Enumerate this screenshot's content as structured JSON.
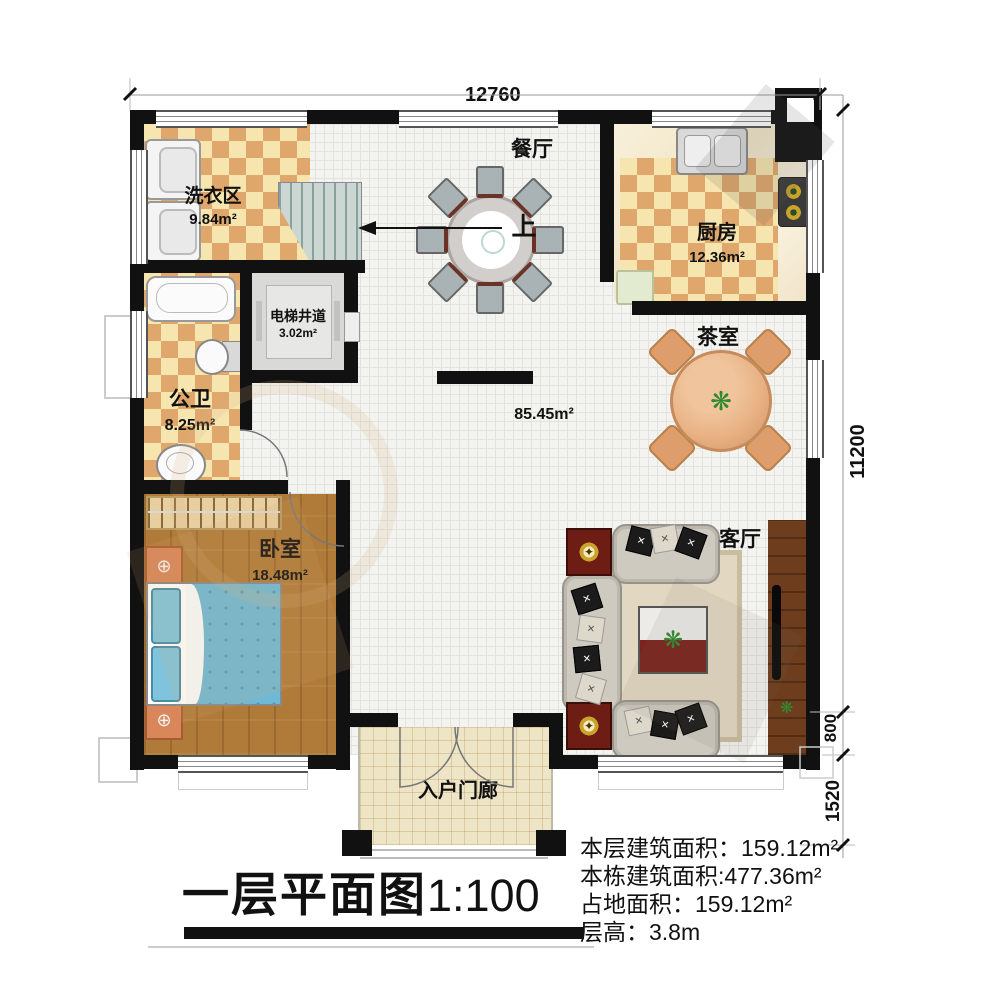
{
  "title": {
    "main": "一层平面图",
    "scale": "1:100"
  },
  "dimensions": {
    "top_width": "12760",
    "right_height": "11200",
    "right_lower": "800",
    "right_bottom": "1520"
  },
  "rooms": {
    "laundry": {
      "name": "洗衣区",
      "area": "9.84m²"
    },
    "dining": {
      "name": "餐厅"
    },
    "kitchen": {
      "name": "厨房",
      "area": "12.36m²"
    },
    "elevator": {
      "name": "电梯井道",
      "area": "3.02m²"
    },
    "bathroom": {
      "name": "公卫",
      "area": "8.25m²"
    },
    "hall": {
      "area": "85.45m²"
    },
    "tea": {
      "name": "茶室"
    },
    "bedroom": {
      "name": "卧室",
      "area": "18.48m²"
    },
    "living": {
      "name": "客厅"
    },
    "porch": {
      "name": "入户门廊"
    }
  },
  "stairs": {
    "up_label": "上"
  },
  "info": {
    "lines": [
      {
        "label": "本层建筑面积：",
        "value": "159.12m²"
      },
      {
        "label": "本栋建筑面积:",
        "value": "477.36m²"
      },
      {
        "label": "占地面积：",
        "value": "159.12m²"
      },
      {
        "label": "层高：",
        "value": "3.8m"
      }
    ]
  },
  "colors": {
    "wall": "#111111",
    "checker_dark": "#e0a76c",
    "checker_light": "#f7e5b0",
    "bedroom_wood": "#b07b39",
    "bed_blue": "#6fb9d6",
    "furniture_red": "#6e1d14",
    "tea_table_tan": "#e8b183"
  }
}
